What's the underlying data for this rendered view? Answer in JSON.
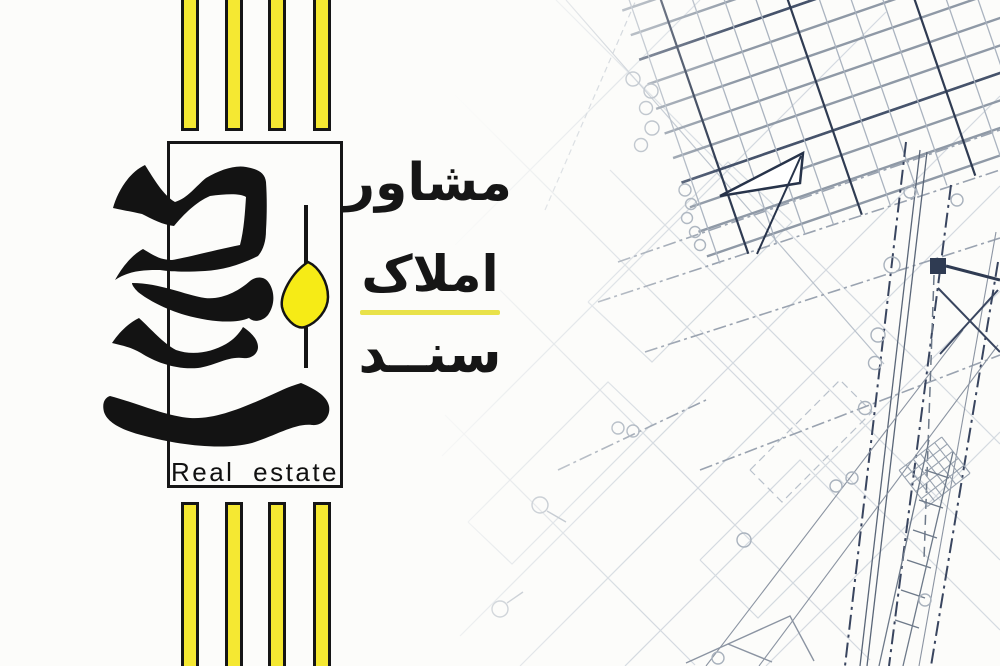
{
  "poster": {
    "brand": {
      "calligraphy_word_fa": "سند",
      "tagline_en": "Real estate"
    },
    "headline": {
      "line1_fa": "مشاور",
      "line2_fa": "املاک",
      "line3_fa": "سنــد"
    },
    "stripes": {
      "top_count": 4,
      "bottom_count": 4
    },
    "colors": {
      "accent_yellow": "#F5E832",
      "leaf_yellow": "#F6EB16",
      "divider_yellow": "#E9E24A",
      "ink": "#161616",
      "blueprint_light": "#CBD2DA",
      "blueprint_mid": "#9AA3B0",
      "blueprint_dark": "#2F3B52"
    }
  }
}
